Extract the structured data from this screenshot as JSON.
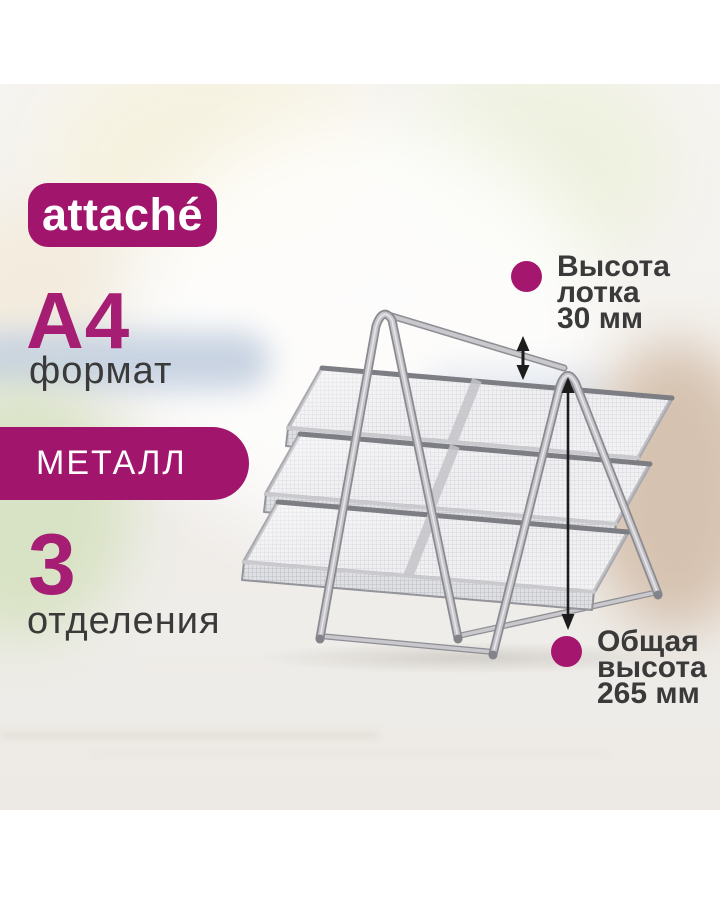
{
  "colors": {
    "brand_magenta": "#A1156C",
    "accent_magenta": "#A61E74",
    "bullet_magenta": "#A5176F",
    "text_dark": "#3A3A3A",
    "arrow_black": "#1C1C1C",
    "tray_silver": "#B7B7BC"
  },
  "logo": {
    "text": "attaché"
  },
  "specs": {
    "format": {
      "value": "A4",
      "label": "формат"
    },
    "material": {
      "label": "МЕТАЛЛ"
    },
    "compartments": {
      "value": "3",
      "label": "отделения"
    }
  },
  "annotations": {
    "tray_height": {
      "lines": [
        "Высота",
        "лотка",
        "30 мм"
      ]
    },
    "total_height": {
      "lines": [
        "Общая",
        "высота",
        "265 мм"
      ]
    }
  }
}
